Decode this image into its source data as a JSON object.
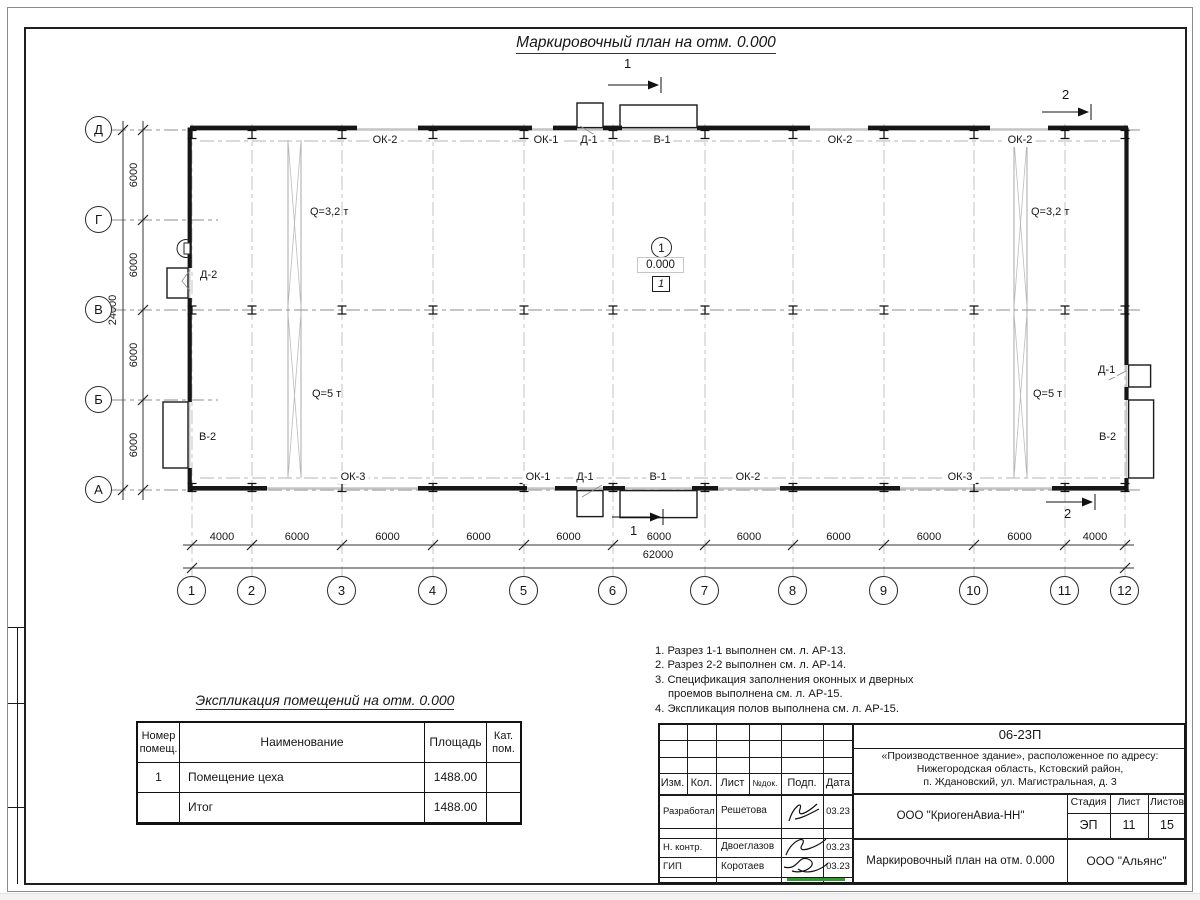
{
  "sheet": {
    "title": "Маркировочный план на отм. 0.000"
  },
  "plan": {
    "axes_cols": [
      "1",
      "2",
      "3",
      "4",
      "5",
      "6",
      "7",
      "8",
      "9",
      "10",
      "11",
      "12"
    ],
    "axes_rows": [
      "Д",
      "Г",
      "В",
      "Б",
      "А"
    ],
    "dims_bottom": [
      "4000",
      "6000",
      "6000",
      "6000",
      "6000",
      "6000",
      "6000",
      "6000",
      "6000",
      "6000",
      "4000"
    ],
    "dim_bottom_total": "62000",
    "dims_left": [
      "6000",
      "6000",
      "6000",
      "6000"
    ],
    "dim_left_total": "24000",
    "top_labels": [
      "ОК-2",
      "ОК-1",
      "Д-1",
      "В-1",
      "ОК-2",
      "ОК-2"
    ],
    "bottom_labels": [
      "ОК-3",
      "ОК-1",
      "Д-1",
      "В-1",
      "ОК-2",
      "ОК-3"
    ],
    "left_labels": [
      "Д-2",
      "В-2"
    ],
    "right_labels": [
      "Д-1",
      "В-2"
    ],
    "crane_left_top": "Q=3,2 т",
    "crane_left_bottom": "Q=5 т",
    "crane_right_top": "Q=3,2 т",
    "crane_right_bottom": "Q=5 т",
    "section1": "1",
    "section2": "2",
    "room_marker": {
      "number": "1",
      "elevation": "0.000",
      "zone": "1"
    }
  },
  "notes": [
    "1. Разрез 1-1 выполнен см. л. АР-13.",
    "2. Разрез 2-2 выполнен см. л. АР-14.",
    "3. Спецификация заполнения оконных и дверных",
    "проемов выполнена см. л. АР-15.",
    "4. Экспликация полов выполнена см. л. АР-15."
  ],
  "room_table": {
    "title": "Экспликация помещений на отм. 0.000",
    "headers": {
      "col1a": "Номер",
      "col1b": "помещ.",
      "col2": "Наименование",
      "col3": "Площадь",
      "col4a": "Кат.",
      "col4b": "пом."
    },
    "rows": [
      {
        "num": "1",
        "name": "Помещение цеха",
        "area": "1488.00",
        "cat": ""
      },
      {
        "num": "",
        "name": "Итог",
        "area": "1488.00",
        "cat": ""
      }
    ]
  },
  "title_block": {
    "doc_number": "06-23П",
    "project_line1": "«Производственное здание», расположенное по адресу:",
    "project_line2": "Нижегородская область, Кстовский район,",
    "project_line3": "п. Ждановский, ул. Магистральная, д. 3",
    "header_cells": [
      "Изм.",
      "Кол.",
      "Лист",
      "№док.",
      "Подп.",
      "Дата"
    ],
    "roles": [
      {
        "role": "Разработал",
        "name": "Решетова",
        "date": "03.23"
      },
      {
        "role": "Н. контр.",
        "name": "Двоеглазов",
        "date": "03.23"
      },
      {
        "role": "ГИП",
        "name": "Коротаев",
        "date": "03.23"
      }
    ],
    "company": "ООО \"КриогенАвиа-НН\"",
    "stage_label": "Стадия",
    "sheet_label": "Лист",
    "sheets_label": "Листов",
    "stage": "ЭП",
    "sheet_no": "11",
    "sheets_total": "15",
    "drawing_name": "Маркировочный план на отм. 0.000",
    "contractor": "ООО \"Альянс\""
  }
}
